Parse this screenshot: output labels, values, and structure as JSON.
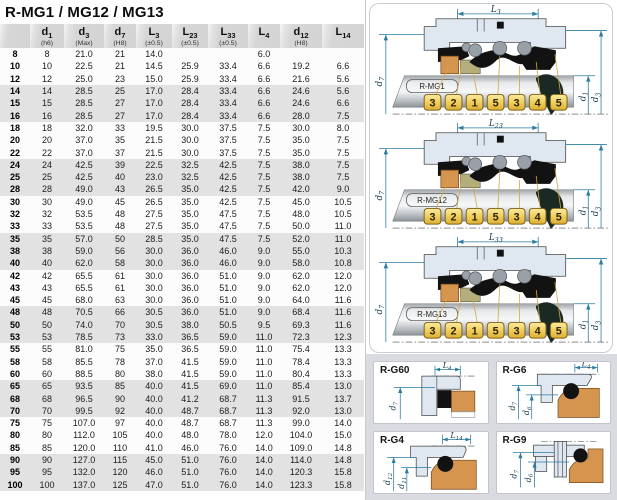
{
  "title": "R-MG1 / MG12 / MG13",
  "colors": {
    "dimension_lines": "#2b7ba3",
    "badge_fill": "#eec84f",
    "badge_border": "#7d5f17",
    "housing_fill": "#dfe8f0",
    "orange_part": "#d6954f",
    "olive_part": "#b3ae7e",
    "black_part": "#121212",
    "row_stripe": "#e2e2e2",
    "panel_gray": "#d9dbe0"
  },
  "table": {
    "columns": [
      {
        "main": "",
        "sub": "",
        "note": ""
      },
      {
        "main": "d",
        "sub": "1",
        "note": "(h6)"
      },
      {
        "main": "d",
        "sub": "3",
        "note": "(Max)"
      },
      {
        "main": "d",
        "sub": "7",
        "note": "(H8)"
      },
      {
        "main": "L",
        "sub": "3",
        "note": "(±0.5)"
      },
      {
        "main": "L",
        "sub": "23",
        "note": "(±0.5)"
      },
      {
        "main": "L",
        "sub": "33",
        "note": "(±0.5)"
      },
      {
        "main": "L",
        "sub": "4",
        "note": ""
      },
      {
        "main": "d",
        "sub": "12",
        "note": "(H8)"
      },
      {
        "main": "L",
        "sub": "14",
        "note": ""
      }
    ],
    "rows": [
      [
        "8",
        "8",
        "21.0",
        "21",
        "14.0",
        "",
        "",
        "6.0",
        "",
        ""
      ],
      [
        "10",
        "10",
        "22.5",
        "21",
        "14.5",
        "25.9",
        "33.4",
        "6.6",
        "19.2",
        "6.6"
      ],
      [
        "12",
        "12",
        "25.0",
        "23",
        "15.0",
        "25.9",
        "33.4",
        "6.6",
        "21.6",
        "5.6"
      ],
      [
        "14",
        "14",
        "28.5",
        "25",
        "17.0",
        "28.4",
        "33.4",
        "6.6",
        "24.6",
        "5.6"
      ],
      [
        "15",
        "15",
        "28.5",
        "27",
        "17.0",
        "28.4",
        "33.4",
        "6.6",
        "24.6",
        "6.6"
      ],
      [
        "16",
        "16",
        "28.5",
        "27",
        "17.0",
        "28.4",
        "33.4",
        "6.6",
        "28.0",
        "7.5"
      ],
      [
        "18",
        "18",
        "32.0",
        "33",
        "19.5",
        "30.0",
        "37.5",
        "7.5",
        "30.0",
        "8.0"
      ],
      [
        "20",
        "20",
        "37.0",
        "35",
        "21.5",
        "30.0",
        "37.5",
        "7.5",
        "35.0",
        "7.5"
      ],
      [
        "22",
        "22",
        "37.0",
        "37",
        "21.5",
        "30.0",
        "37.5",
        "7.5",
        "35.0",
        "7.5"
      ],
      [
        "24",
        "24",
        "42.5",
        "39",
        "22.5",
        "32.5",
        "42.5",
        "7.5",
        "38.0",
        "7.5"
      ],
      [
        "25",
        "25",
        "42.5",
        "40",
        "23.0",
        "32.5",
        "42.5",
        "7.5",
        "38.0",
        "7.5"
      ],
      [
        "28",
        "28",
        "49.0",
        "43",
        "26.5",
        "35.0",
        "42.5",
        "7.5",
        "42.0",
        "9.0"
      ],
      [
        "30",
        "30",
        "49.0",
        "45",
        "26.5",
        "35.0",
        "42.5",
        "7.5",
        "45.0",
        "10.5"
      ],
      [
        "32",
        "32",
        "53.5",
        "48",
        "27.5",
        "35.0",
        "47.5",
        "7.5",
        "48.0",
        "10.5"
      ],
      [
        "33",
        "33",
        "53.5",
        "48",
        "27.5",
        "35.0",
        "47.5",
        "7.5",
        "50.0",
        "11.0"
      ],
      [
        "35",
        "35",
        "57.0",
        "50",
        "28.5",
        "35.0",
        "47.5",
        "7.5",
        "52.0",
        "11.0"
      ],
      [
        "38",
        "38",
        "59.0",
        "56",
        "30.0",
        "36.0",
        "46.0",
        "9.0",
        "55.0",
        "10.3"
      ],
      [
        "40",
        "40",
        "62.0",
        "58",
        "30.0",
        "36.0",
        "46.0",
        "9.0",
        "58.0",
        "10.8"
      ],
      [
        "42",
        "42",
        "65.5",
        "61",
        "30.0",
        "36.0",
        "51.0",
        "9.0",
        "62.0",
        "12.0"
      ],
      [
        "43",
        "43",
        "65.5",
        "61",
        "30.0",
        "36.0",
        "51.0",
        "9.0",
        "62.0",
        "12.0"
      ],
      [
        "45",
        "45",
        "68.0",
        "63",
        "30.0",
        "36.0",
        "51.0",
        "9.0",
        "64.0",
        "11.6"
      ],
      [
        "48",
        "48",
        "70.5",
        "66",
        "30.5",
        "36.0",
        "51.0",
        "9.0",
        "68.4",
        "11.6"
      ],
      [
        "50",
        "50",
        "74.0",
        "70",
        "30.5",
        "38.0",
        "50.5",
        "9.5",
        "69.3",
        "11.6"
      ],
      [
        "53",
        "53",
        "78.5",
        "73",
        "33.0",
        "36.5",
        "59.0",
        "11.0",
        "72.3",
        "12.3"
      ],
      [
        "55",
        "55",
        "81.0",
        "75",
        "35.0",
        "36.5",
        "59.0",
        "11.0",
        "75.4",
        "13.3"
      ],
      [
        "58",
        "58",
        "85.5",
        "78",
        "37.0",
        "41.5",
        "59.0",
        "11.0",
        "78.4",
        "13.3"
      ],
      [
        "60",
        "60",
        "88.5",
        "80",
        "38.0",
        "41.5",
        "59.0",
        "11.0",
        "80.4",
        "13.3"
      ],
      [
        "65",
        "65",
        "93.5",
        "85",
        "40.0",
        "41.5",
        "69.0",
        "11.0",
        "85.4",
        "13.0"
      ],
      [
        "68",
        "68",
        "96.5",
        "90",
        "40.0",
        "41.2",
        "68.7",
        "11.3",
        "91.5",
        "13.7"
      ],
      [
        "70",
        "70",
        "99.5",
        "92",
        "40.0",
        "48.7",
        "68.7",
        "11.3",
        "92.0",
        "13.0"
      ],
      [
        "75",
        "75",
        "107.0",
        "97",
        "40.0",
        "48.7",
        "68.7",
        "11.3",
        "99.0",
        "14.0"
      ],
      [
        "80",
        "80",
        "112.0",
        "105",
        "40.0",
        "48.0",
        "78.0",
        "12.0",
        "104.0",
        "15.0"
      ],
      [
        "85",
        "85",
        "120.0",
        "110",
        "41.0",
        "46.0",
        "76.0",
        "14.0",
        "109.0",
        "14.8"
      ],
      [
        "90",
        "90",
        "127.0",
        "115",
        "45.0",
        "51.0",
        "76.0",
        "14.0",
        "114.0",
        "14.8"
      ],
      [
        "95",
        "95",
        "132.0",
        "120",
        "46.0",
        "51.0",
        "76.0",
        "14.0",
        "120.3",
        "15.8"
      ],
      [
        "100",
        "100",
        "137.0",
        "125",
        "47.0",
        "51.0",
        "76.0",
        "14.0",
        "123.3",
        "15.8"
      ]
    ]
  },
  "diagrams": {
    "mg": [
      {
        "label": "R-MG1",
        "top_dim": {
          "main": "L",
          "sub": "3"
        },
        "left_dim": {
          "main": "d",
          "sub": "7"
        },
        "right_dims": [
          {
            "main": "d",
            "sub": "1"
          },
          {
            "main": "d",
            "sub": "3"
          }
        ],
        "badges": [
          "3",
          "2",
          "1",
          "5",
          "3",
          "4",
          "5"
        ]
      },
      {
        "label": "R-MG12",
        "top_dim": {
          "main": "L",
          "sub": "23"
        },
        "left_dim": {
          "main": "d",
          "sub": "7"
        },
        "right_dims": [
          {
            "main": "d",
            "sub": "1"
          },
          {
            "main": "d",
            "sub": "3"
          }
        ],
        "badges": [
          "3",
          "2",
          "1",
          "5",
          "3",
          "4",
          "5"
        ]
      },
      {
        "label": "R-MG13",
        "top_dim": {
          "main": "L",
          "sub": "33"
        },
        "left_dim": {
          "main": "d",
          "sub": "7"
        },
        "right_dims": [
          {
            "main": "d",
            "sub": "1"
          },
          {
            "main": "d",
            "sub": "3"
          }
        ],
        "badges": [
          "3",
          "2",
          "1",
          "5",
          "3",
          "4",
          "5"
        ]
      }
    ],
    "g": [
      {
        "label": "R-G60",
        "top_dim": {
          "main": "L",
          "sub": "4"
        },
        "left_dims": [
          {
            "main": "d",
            "sub": "7"
          }
        ]
      },
      {
        "label": "R-G6",
        "top_dim": {
          "main": "L",
          "sub": "4"
        },
        "left_dims": [
          {
            "main": "d",
            "sub": "7"
          },
          {
            "main": "d",
            "sub": "6"
          }
        ]
      },
      {
        "label": "R-G4",
        "top_dim": {
          "main": "L",
          "sub": "14"
        },
        "left_dims": [
          {
            "main": "d",
            "sub": "12"
          },
          {
            "main": "d",
            "sub": "11"
          }
        ]
      },
      {
        "label": "R-G9",
        "top_dim": null,
        "left_dims": [
          {
            "main": "d",
            "sub": "7"
          },
          {
            "main": "d",
            "sub": "6"
          }
        ]
      }
    ]
  }
}
